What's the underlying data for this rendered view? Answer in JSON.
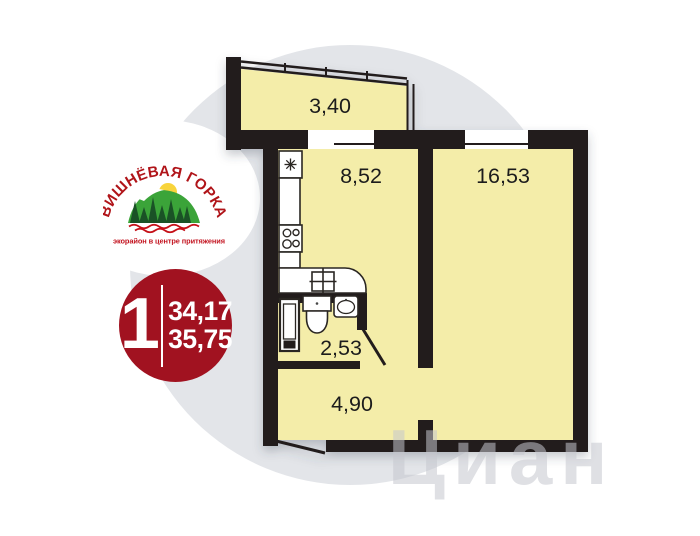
{
  "page": {
    "background_color": "#ffffff",
    "backdrop_circle_color": "#e3e5e9"
  },
  "logo": {
    "title": "ВИШНЁВАЯ ГОРКА",
    "tagline": "экорайон в центре притяжения",
    "title_color": "#b01419",
    "hill_color": "#3ba439",
    "tree_color": "#1a5226",
    "sun_color": "#f8d43b",
    "wave_color": "#c51018"
  },
  "badge": {
    "rooms_count": "1",
    "area_primary": "34,17",
    "area_secondary": "35,75",
    "background_color": "#a11220",
    "text_color": "#ffffff"
  },
  "floorplan": {
    "wall_color": "#241f1c",
    "room_fill_color": "#f4eda9",
    "rooms": [
      {
        "name": "balcony",
        "area": "3,40"
      },
      {
        "name": "kitchen",
        "area": "8,52"
      },
      {
        "name": "living-room",
        "area": "16,53"
      },
      {
        "name": "bathroom",
        "area": "2,53"
      },
      {
        "name": "hallway",
        "area": "4,90"
      }
    ]
  },
  "watermark": {
    "text": "Циан"
  }
}
